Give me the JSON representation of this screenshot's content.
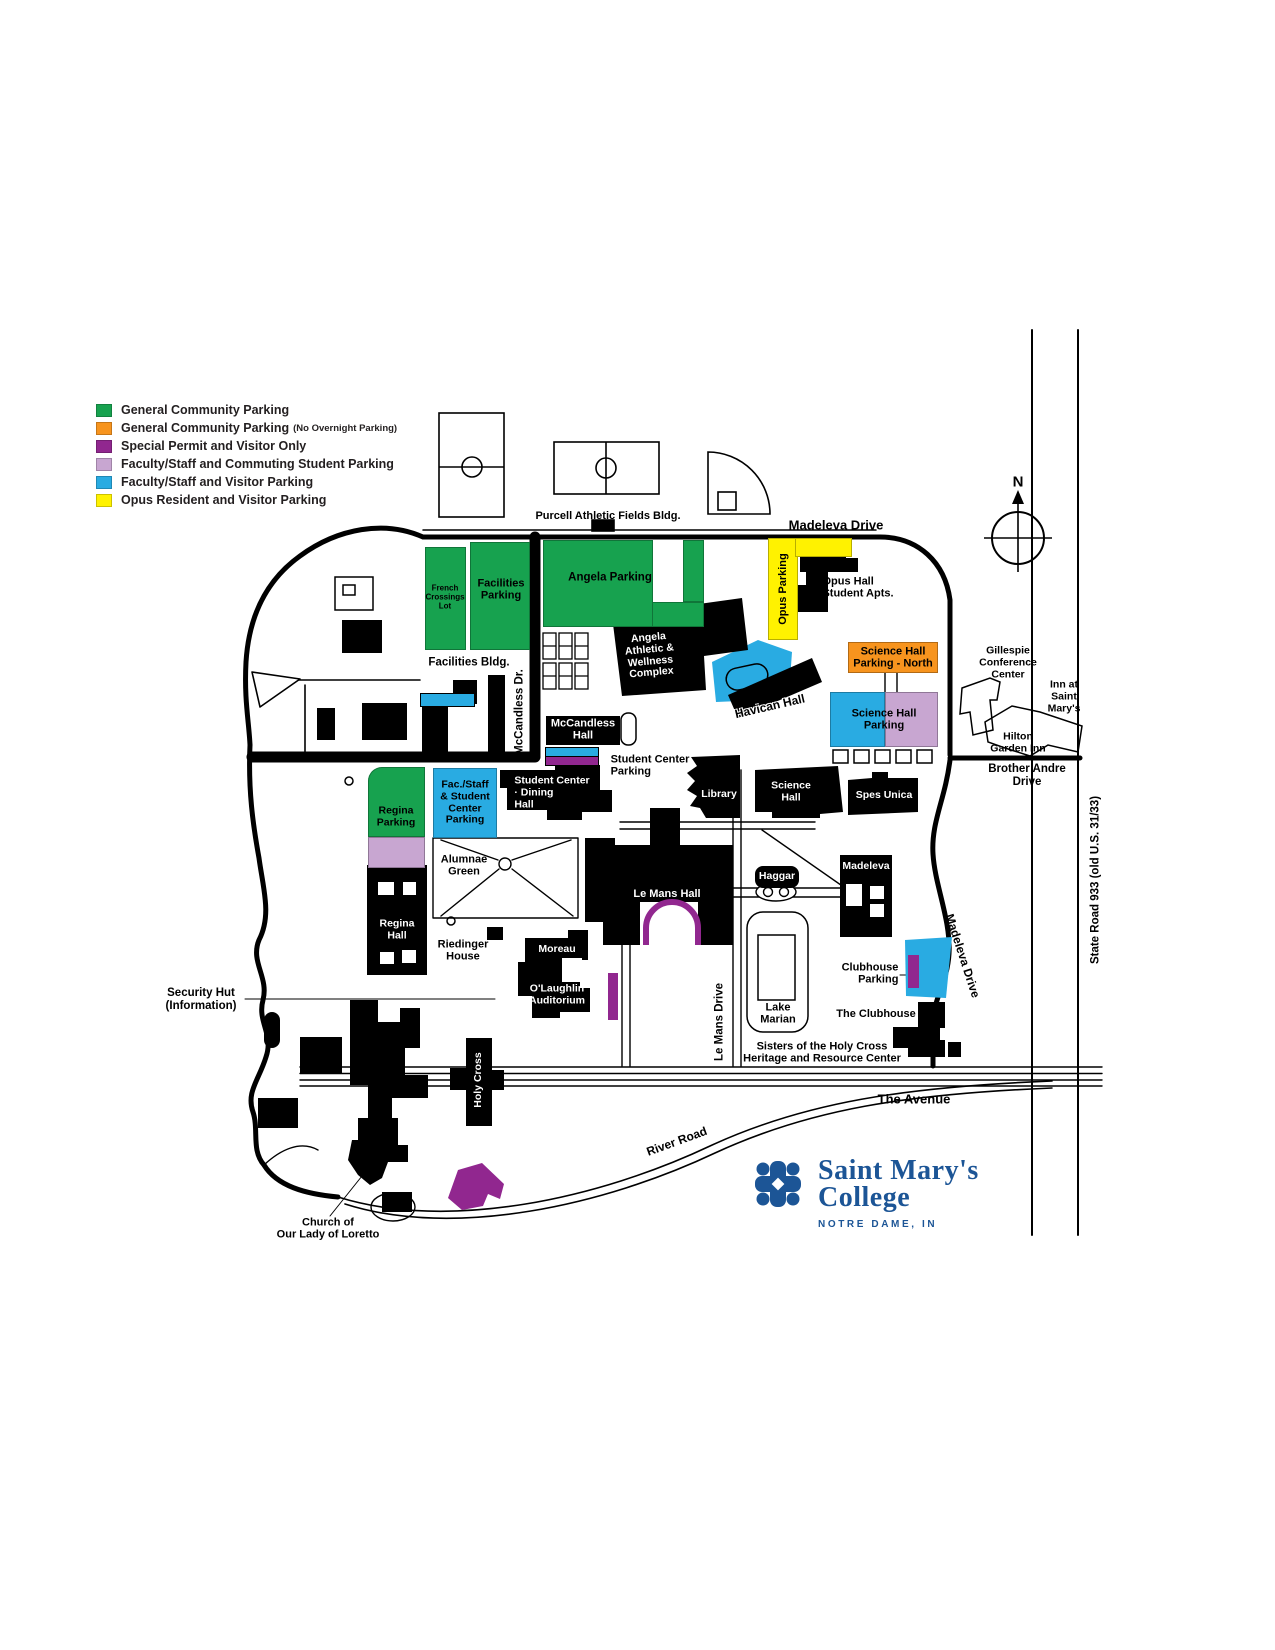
{
  "palette": {
    "general_community": "#17A24F",
    "general_no_overnight": "#F7941E",
    "special_permit_visitor": "#91278F",
    "faculty_commuting_student": "#C8A6D1",
    "faculty_visitor": "#29ABE2",
    "opus_resident_visitor": "#FFF200",
    "logo_blue": "#1C5596"
  },
  "legend": {
    "items": [
      {
        "label": "General Community Parking",
        "note": "",
        "color": "#17A24F"
      },
      {
        "label": "General Community Parking",
        "note": "(No Overnight Parking)",
        "color": "#F7941E"
      },
      {
        "label": "Special Permit and Visitor Only",
        "note": "",
        "color": "#91278F"
      },
      {
        "label": "Faculty/Staff and Commuting Student Parking",
        "note": "",
        "color": "#C8A6D1"
      },
      {
        "label": "Faculty/Staff and Visitor Parking",
        "note": "",
        "color": "#29ABE2"
      },
      {
        "label": "Opus Resident and Visitor Parking",
        "note": "",
        "color": "#FFF200"
      }
    ]
  },
  "compass": {
    "north": "N"
  },
  "roads": {
    "madeleva_top": "Madeleva Drive",
    "madeleva_right": "Madeleva Drive",
    "mccandless": "McCandless Dr.",
    "le_mans": "Le Mans Drive",
    "brother_andre": {
      "lines": [
        "Brother Andre",
        "Drive"
      ]
    },
    "avenue": "The Avenue",
    "river": "River Road",
    "state_road": "State Road 933 (old U.S. 31/33)"
  },
  "parking": {
    "french_crossings": {
      "lines": [
        "French",
        "Crossings",
        "Lot"
      ]
    },
    "facilities": {
      "lines": [
        "Facilities",
        "Parking"
      ]
    },
    "angela": {
      "label": "Angela Parking"
    },
    "opus": {
      "label": "Opus Parking"
    },
    "science_north": {
      "lines": [
        "Science Hall",
        "Parking - North"
      ]
    },
    "science": {
      "lines": [
        "Science Hall",
        "Parking"
      ]
    },
    "student_center": {
      "lines": [
        "Student Center",
        "Parking"
      ]
    },
    "fac_staff": {
      "lines": [
        "Fac./Staff",
        "& Student",
        "Center",
        "Parking"
      ]
    },
    "regina": {
      "lines": [
        "Regina",
        "Parking"
      ]
    },
    "clubhouse": {
      "lines": [
        "Clubhouse",
        "Parking"
      ]
    }
  },
  "buildings": {
    "purcell": "Purcell Athletic Fields Bldg.",
    "facilities_bldg": "Facilities Bldg.",
    "angela_complex": {
      "lines": [
        "Angela",
        "Athletic &",
        "Wellness",
        "Complex"
      ]
    },
    "opus_hall": {
      "lines": [
        "Opus Hall",
        "Student Apts."
      ]
    },
    "mccandless_hall": {
      "lines": [
        "McCandless",
        "Hall"
      ]
    },
    "havican": "Havican Hall",
    "student_center_dining": {
      "lines": [
        "Student Center",
        "· Dining",
        "Hall"
      ]
    },
    "library": "Library",
    "science_hall": {
      "lines": [
        "Science",
        "Hall"
      ]
    },
    "spes_unica": "Spes Unica",
    "haggar": "Haggar",
    "madeleva": "Madeleva",
    "le_mans_hall": "Le Mans Hall",
    "regina_hall": {
      "lines": [
        "Regina",
        "Hall"
      ]
    },
    "moreau": "Moreau",
    "olaughlin": {
      "lines": [
        "O'Laughlin",
        "Auditorium"
      ]
    },
    "holy_cross": "Holy Cross",
    "riedinger": {
      "lines": [
        "Riedinger",
        "House"
      ]
    },
    "the_clubhouse": "The Clubhouse",
    "sisters": {
      "lines": [
        "Sisters of the Holy Cross",
        "Heritage and Resource Center"
      ]
    },
    "church": {
      "lines": [
        "Church of",
        "Our Lady of Loretto"
      ]
    },
    "gillespie": {
      "lines": [
        "Gillespie",
        "Conference",
        "Center"
      ]
    },
    "inn": {
      "lines": [
        "Inn at",
        "Saint",
        "Mary's"
      ]
    },
    "hilton": {
      "lines": [
        "Hilton",
        "Garden Inn"
      ]
    }
  },
  "places": {
    "alumnae_green": {
      "lines": [
        "Alumnae",
        "Green"
      ]
    },
    "lake_marian": {
      "lines": [
        "Lake",
        "Marian"
      ]
    },
    "security_hut": {
      "lines": [
        "Security Hut",
        "(Information)"
      ]
    }
  },
  "logo": {
    "name_line1": "Saint Mary's",
    "name_line2": "College",
    "tagline": "NOTRE DAME, IN"
  }
}
